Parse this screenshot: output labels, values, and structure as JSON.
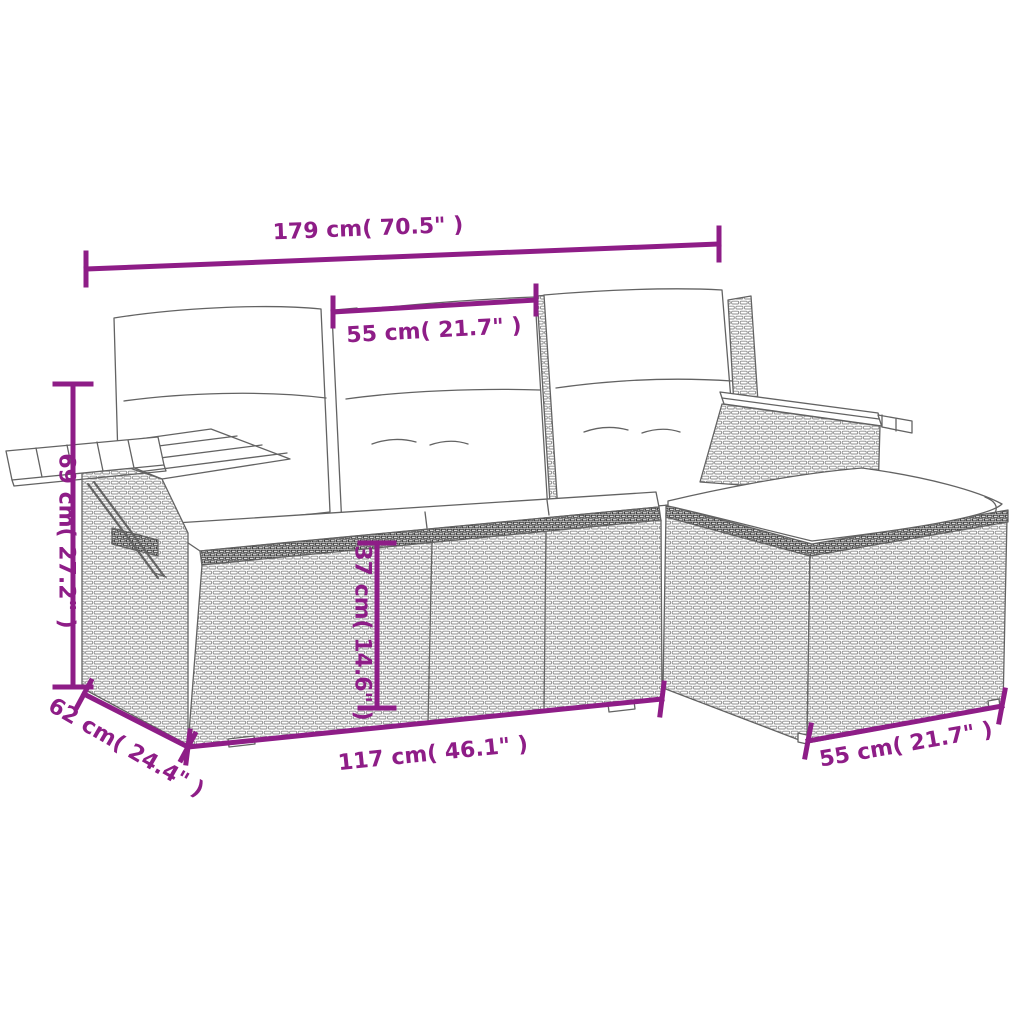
{
  "diagram": {
    "type": "product-dimension-diagram",
    "subject": "rattan garden sofa set with ottoman, white cushions, wooden armrests and fold-out side table",
    "background_color": "#ffffff",
    "accent_color": "#8E1D87",
    "line_art_color": "#636363",
    "dimensions": {
      "total_width": {
        "label": "179 cm( 70.5\" )",
        "cm": 179,
        "inch": 70.5,
        "measures": "overall width of sofa including both armrests"
      },
      "backrest_width": {
        "label": "55 cm( 21.7\" )",
        "cm": 55,
        "inch": 21.7,
        "measures": "width of one back cushion / seat module"
      },
      "height": {
        "label": "69 cm( 27.2\" )",
        "cm": 69,
        "inch": 27.2,
        "measures": "overall height at armrest side"
      },
      "seat_height": {
        "label": "37 cm( 14.6\" )",
        "cm": 37,
        "inch": 14.6,
        "measures": "height of seat base front panel"
      },
      "depth": {
        "label": "62 cm( 24.4\" )",
        "cm": 62,
        "inch": 24.4,
        "measures": "depth of sofa side"
      },
      "sofa_length": {
        "label": "117 cm( 46.1\" )",
        "cm": 117,
        "inch": 46.1,
        "measures": "length of seat base front"
      },
      "ottoman_width": {
        "label": "55 cm( 21.7\" )",
        "cm": 55,
        "inch": 21.7,
        "measures": "width of ottoman front"
      }
    }
  }
}
